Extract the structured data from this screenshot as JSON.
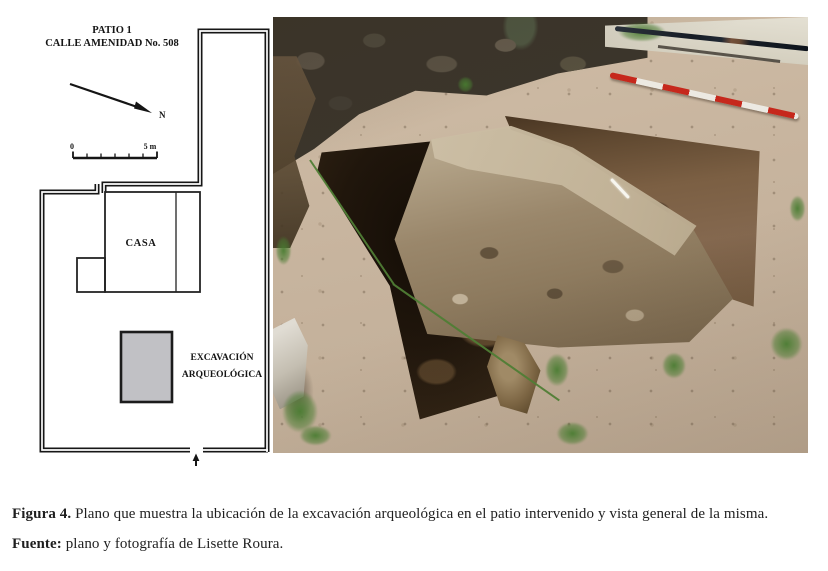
{
  "plan": {
    "title_line1": "PATIO 1",
    "title_line2": "CALLE AMENIDAD No. 508",
    "north_label": "N",
    "scale": {
      "start_label": "0",
      "end_label": "5 m"
    },
    "casa_label": "CASA",
    "excavation_label_line1": "EXCAVACIÓN",
    "excavation_label_line2": "ARQUEOLÓGICA",
    "colors": {
      "wall": "#161616",
      "excavation_fill": "#c1c1c5"
    }
  },
  "photo": {
    "colors": {
      "ground": "#c9b6a0",
      "rock_wall": "#3b352b",
      "concrete_wall": "#d9d4c6",
      "pit_dark": "#20160c",
      "pit_soil": "#7b5f43",
      "masonry": "#9a876b",
      "pole_red": "#c6281c",
      "pole_white": "#ece9e2",
      "grass": "#497c31"
    }
  },
  "caption": {
    "figure_label": "Figura 4.",
    "figure_text": " Plano que muestra la ubicación de la excavación arqueológica en el patio intervenido y vista general de la misma.",
    "source_label": "Fuente:",
    "source_text": " plano y fotografía de Lisette Roura."
  }
}
